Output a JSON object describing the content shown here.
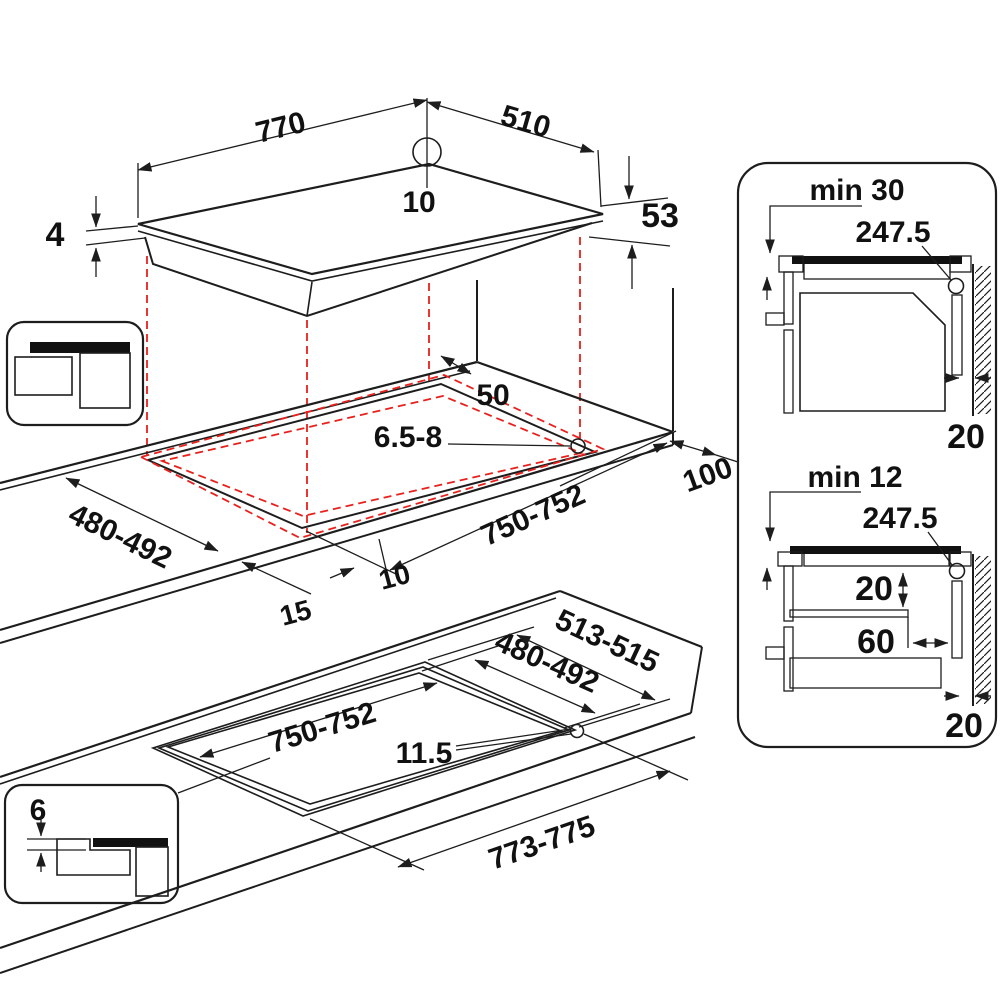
{
  "views": {
    "top": {
      "width": "770",
      "depth": "510",
      "hole_offset": "10",
      "glass_height": "4",
      "body_height": "53"
    },
    "middle": {
      "rear_gap": "50",
      "fixing_depth": "6.5-8",
      "side_gap": "100",
      "cutout_depth": "480-492",
      "cutout_width": "750-752",
      "front_edge": "15",
      "edge_offset": "10"
    },
    "bottom": {
      "outer_depth": "513-515",
      "inner_depth": "480-492",
      "inner_width": "750-752",
      "rebate": "11.5",
      "outer_width": "773-775"
    },
    "panel": {
      "top": {
        "title": "min 30",
        "center_ref": "247.5",
        "wall_gap": "20"
      },
      "bottom": {
        "title": "min 12",
        "center_ref": "247.5",
        "shelf_gap": "20",
        "shelf_inset": "60",
        "wall_gap": "20"
      }
    },
    "insets": {
      "flush_step": "6"
    }
  },
  "colors": {
    "line": "#1d1d1d",
    "red_dashed": "#e8211d",
    "gray_mid": "#b5b5b5",
    "gray_light": "#d2d2d2",
    "gray_dark": "#9a9a9a",
    "black_fill": "#111111"
  }
}
